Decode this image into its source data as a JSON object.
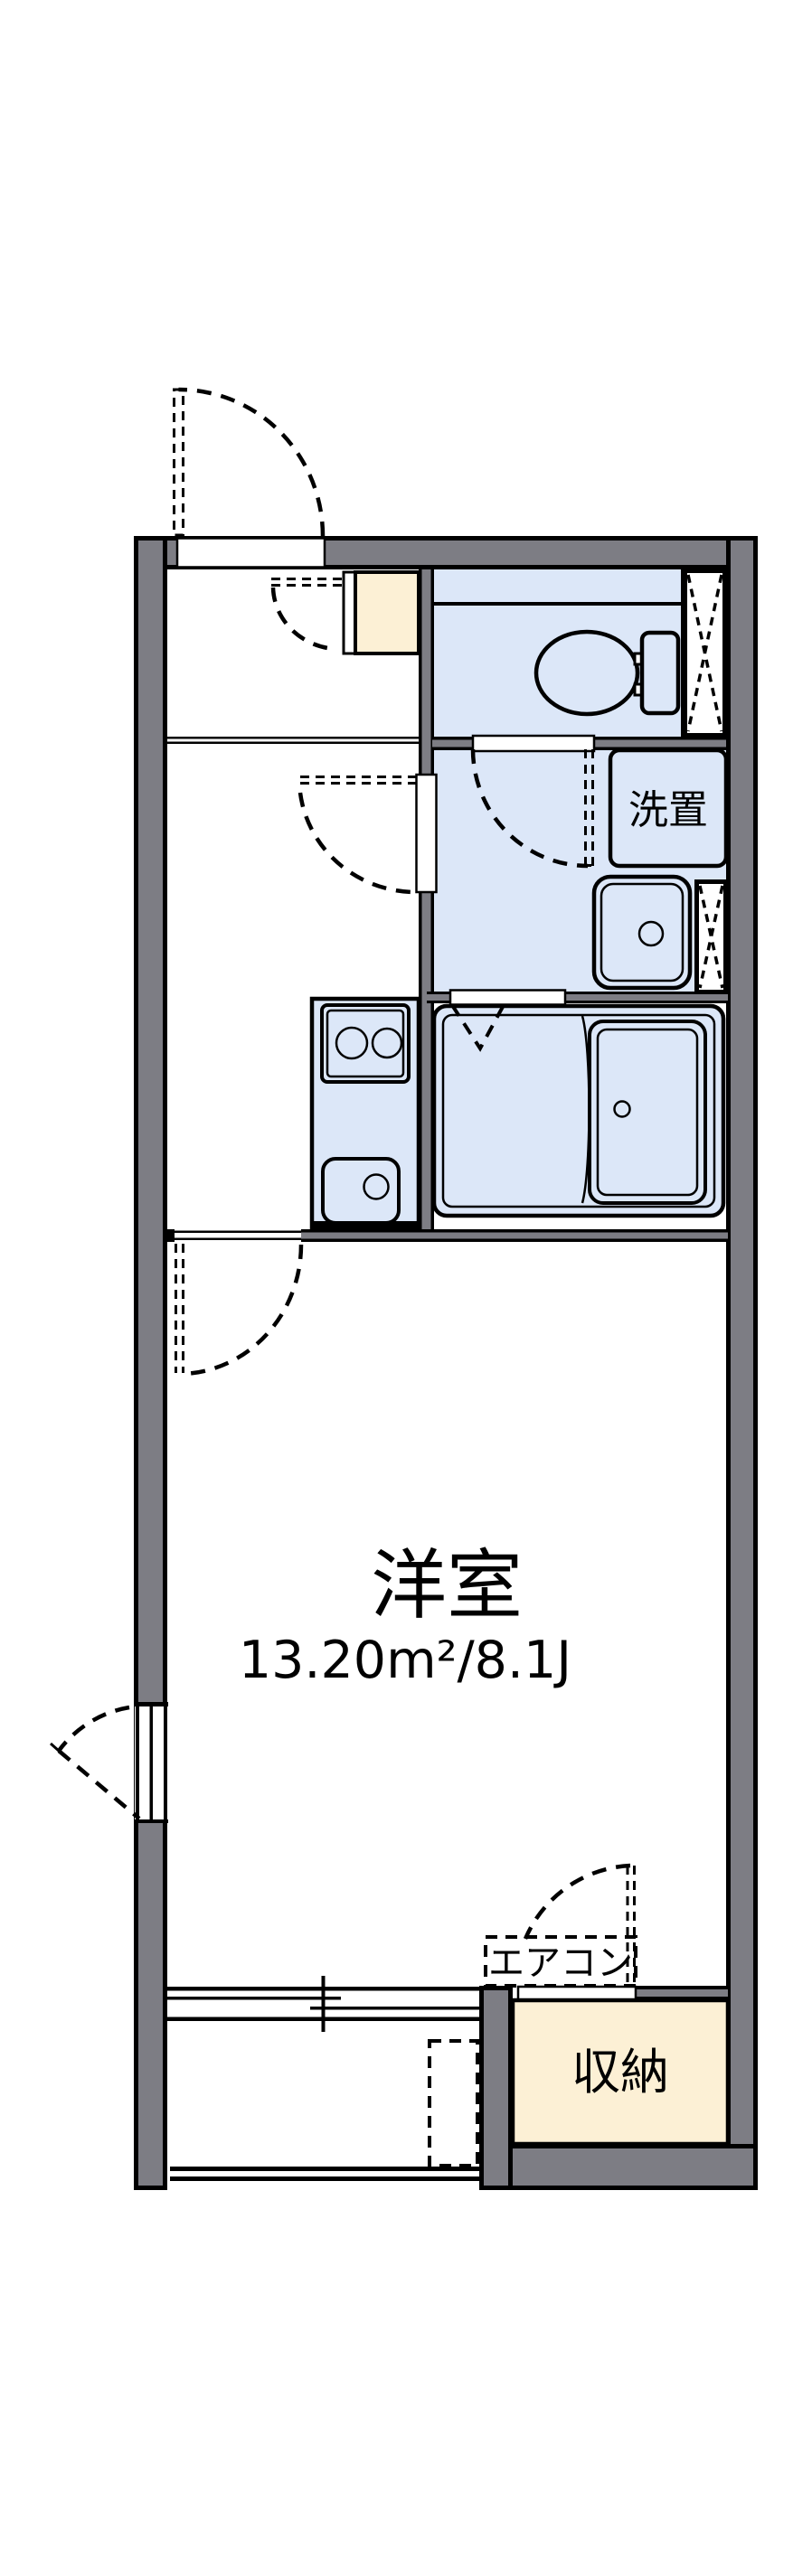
{
  "floorplan": {
    "labels": {
      "western_room_name": "洋室",
      "western_room_area": "13.20m²/8.1J",
      "washer_place": "洗置",
      "storage": "収納",
      "air_conditioner": "エアコン"
    },
    "colors": {
      "wall": "#7d7d84",
      "wet": "#dce7f8",
      "cream": "#fcf0d5",
      "line": "#000000",
      "bg": "#ffffff"
    }
  }
}
